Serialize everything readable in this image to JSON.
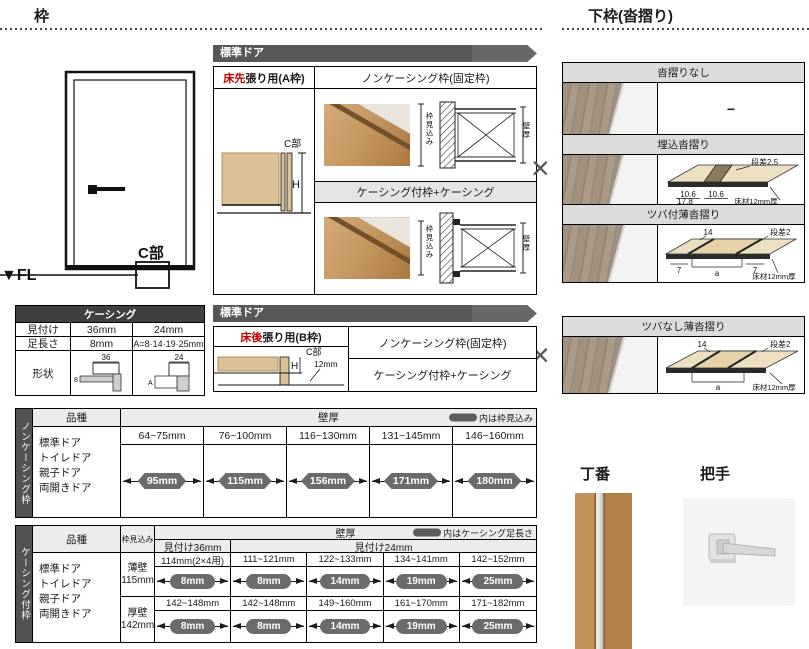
{
  "titles": {
    "left": "枠",
    "right": "下枠(沓摺り)"
  },
  "door": {
    "fl": "▼FL",
    "c_part": "C部"
  },
  "cross_mark": "×",
  "frame_a": {
    "banner": "標準ドア",
    "header_red": "床先",
    "header_rest": "張り用(A枠)",
    "c_part": "C部",
    "h": "H",
    "noncasing_title": "ノンケーシング枠(固定枠)",
    "casing_title": "ケーシング付枠+ケーシング",
    "dim_mikomi": "枠見込み",
    "dim_wall": "壁厚"
  },
  "frame_b": {
    "banner": "標準ドア",
    "header_red": "床後",
    "header_rest": "張り用(B枠)",
    "c_part": "C部",
    "h": "H",
    "dim12": "12mm",
    "noncasing_title": "ノンケーシング枠(固定枠)",
    "casing_title": "ケーシング付枠+ケーシング"
  },
  "casing_spec": {
    "title": "ケーシング",
    "row1_label": "見付け",
    "row1_c1": "36mm",
    "row1_c2": "24mm",
    "row2_label": "足長さ",
    "row2_c1": "8mm",
    "row2_c2": "A=8·14·19·25mm",
    "row3_label": "形状",
    "shape1_top": "36",
    "shape1_left": "8",
    "shape2_top": "24",
    "shape2_left": "A"
  },
  "thresholds": {
    "none": {
      "title": "沓摺りなし",
      "dash": "−"
    },
    "umekomi": {
      "title": "埋込沓摺り",
      "step": "段差2.5",
      "d1": "10.6",
      "d2": "10.6",
      "d3": "17.8",
      "floor": "床材12mm厚"
    },
    "tsuba": {
      "title": "ツバ付薄沓摺り",
      "w": "14",
      "step": "段差2",
      "d1": "7",
      "a": "a",
      "d2": "7",
      "floor": "床材12mm厚"
    },
    "tsubanashi": {
      "title": "ツバなし薄沓摺り",
      "w": "14",
      "step": "段差2",
      "a": "a",
      "floor": "床材12mm厚"
    }
  },
  "noncasing_table": {
    "side": "ノンケーシング枠",
    "hinshu": "品種",
    "wall": "壁厚",
    "note": "内は枠見込み",
    "products": [
      "標準ドア",
      "トイレドア",
      "親子ドア",
      "両開きドア"
    ],
    "cols": [
      {
        "range": "64~75mm",
        "value": "95mm"
      },
      {
        "range": "76~100mm",
        "value": "115mm"
      },
      {
        "range": "116~130mm",
        "value": "156mm"
      },
      {
        "range": "131~145mm",
        "value": "171mm"
      },
      {
        "range": "146~160mm",
        "value": "180mm"
      }
    ]
  },
  "casing_table": {
    "side": "ケーシング付枠",
    "hinshu": "品種",
    "mikomi": "枠見込み",
    "wall": "壁厚",
    "note": "内はケーシング足長さ",
    "group36": "見付け36mm",
    "group24": "見付け24mm",
    "products": [
      "標準ドア",
      "トイレドア",
      "親子ドア",
      "両開きドア"
    ],
    "rows": [
      {
        "wall_type": "薄壁",
        "wall_size": "115mm",
        "cells": [
          {
            "range": "114mm(2×4用)",
            "value": "8mm"
          },
          {
            "range": "111~121mm",
            "value": "8mm"
          },
          {
            "range": "122~133mm",
            "value": "14mm"
          },
          {
            "range": "134~141mm",
            "value": "19mm"
          },
          {
            "range": "142~152mm",
            "value": "25mm"
          }
        ]
      },
      {
        "wall_type": "厚壁",
        "wall_size": "142mm",
        "cells": [
          {
            "range": "142~148mm",
            "value": "8mm"
          },
          {
            "range": "142~148mm",
            "value": "8mm"
          },
          {
            "range": "149~160mm",
            "value": "14mm"
          },
          {
            "range": "161~170mm",
            "value": "19mm"
          },
          {
            "range": "171~182mm",
            "value": "25mm"
          }
        ]
      }
    ]
  },
  "hardware": {
    "hinge": "丁番",
    "handle": "把手"
  }
}
